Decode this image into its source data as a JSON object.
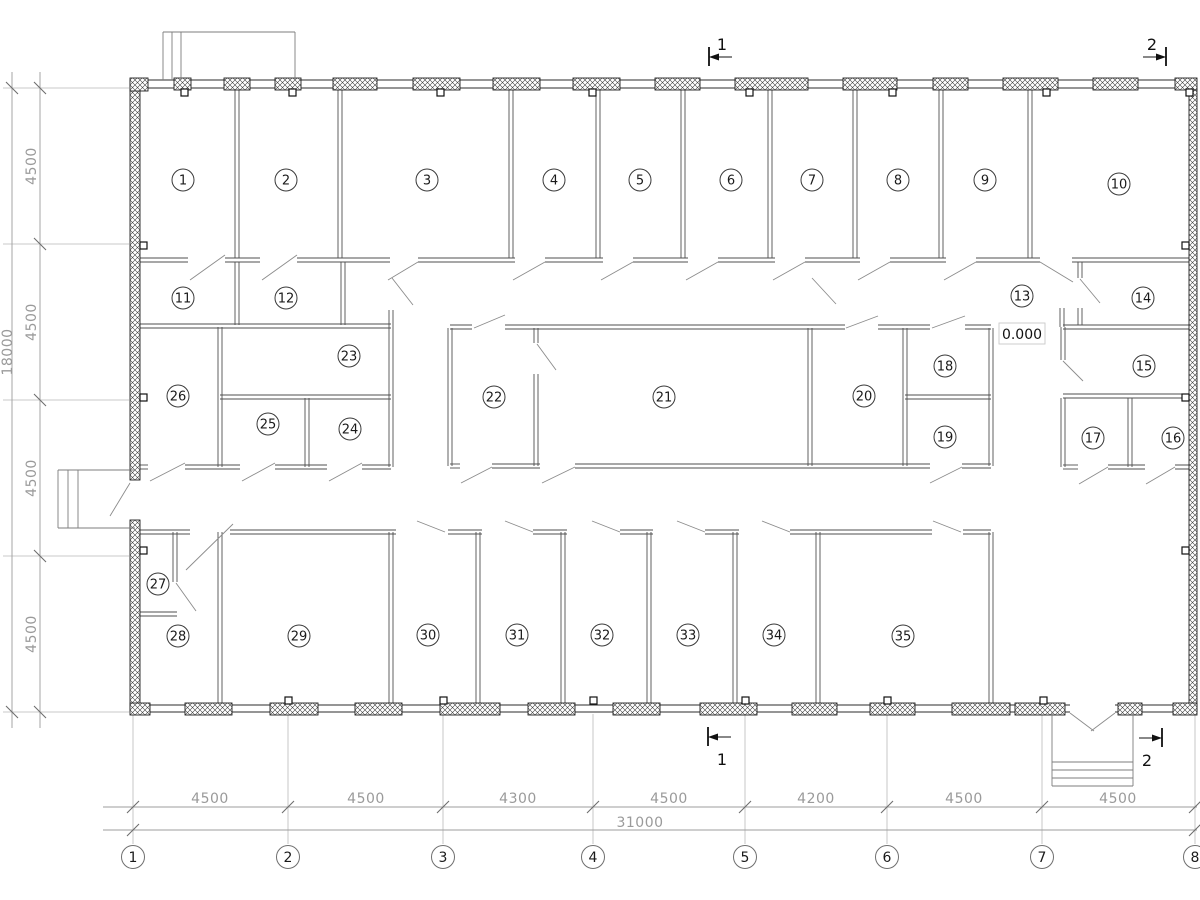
{
  "rooms": [
    {
      "n": "1",
      "x": 183,
      "y": 180
    },
    {
      "n": "2",
      "x": 286,
      "y": 180
    },
    {
      "n": "3",
      "x": 427,
      "y": 180
    },
    {
      "n": "4",
      "x": 554,
      "y": 180
    },
    {
      "n": "5",
      "x": 640,
      "y": 180
    },
    {
      "n": "6",
      "x": 731,
      "y": 180
    },
    {
      "n": "7",
      "x": 812,
      "y": 180
    },
    {
      "n": "8",
      "x": 898,
      "y": 180
    },
    {
      "n": "9",
      "x": 985,
      "y": 180
    },
    {
      "n": "10",
      "x": 1119,
      "y": 184
    },
    {
      "n": "11",
      "x": 183,
      "y": 298
    },
    {
      "n": "12",
      "x": 286,
      "y": 298
    },
    {
      "n": "13",
      "x": 1022,
      "y": 296
    },
    {
      "n": "14",
      "x": 1143,
      "y": 298
    },
    {
      "n": "15",
      "x": 1144,
      "y": 366
    },
    {
      "n": "16",
      "x": 1173,
      "y": 438
    },
    {
      "n": "17",
      "x": 1093,
      "y": 438
    },
    {
      "n": "18",
      "x": 945,
      "y": 366
    },
    {
      "n": "19",
      "x": 945,
      "y": 437
    },
    {
      "n": "20",
      "x": 864,
      "y": 396
    },
    {
      "n": "21",
      "x": 664,
      "y": 397
    },
    {
      "n": "22",
      "x": 494,
      "y": 397
    },
    {
      "n": "23",
      "x": 349,
      "y": 356
    },
    {
      "n": "24",
      "x": 350,
      "y": 429
    },
    {
      "n": "25",
      "x": 268,
      "y": 424
    },
    {
      "n": "26",
      "x": 178,
      "y": 396
    },
    {
      "n": "27",
      "x": 158,
      "y": 584
    },
    {
      "n": "28",
      "x": 178,
      "y": 636
    },
    {
      "n": "29",
      "x": 299,
      "y": 636
    },
    {
      "n": "30",
      "x": 428,
      "y": 635
    },
    {
      "n": "31",
      "x": 517,
      "y": 635
    },
    {
      "n": "32",
      "x": 602,
      "y": 635
    },
    {
      "n": "33",
      "x": 688,
      "y": 635
    },
    {
      "n": "34",
      "x": 774,
      "y": 635
    },
    {
      "n": "35",
      "x": 903,
      "y": 636
    }
  ],
  "grid_axis": {
    "y": 857,
    "items": [
      {
        "label": "1",
        "x": 133
      },
      {
        "label": "2",
        "x": 288
      },
      {
        "label": "3",
        "x": 443
      },
      {
        "label": "4",
        "x": 593
      },
      {
        "label": "5",
        "x": 745
      },
      {
        "label": "6",
        "x": 887
      },
      {
        "label": "7",
        "x": 1042
      },
      {
        "label": "8",
        "x": 1195
      }
    ]
  },
  "dims_bottom": {
    "chain": [
      {
        "label": "4500",
        "x": 210
      },
      {
        "label": "4500",
        "x": 366
      },
      {
        "label": "4300",
        "x": 518
      },
      {
        "label": "4500",
        "x": 669
      },
      {
        "label": "4200",
        "x": 816
      },
      {
        "label": "4500",
        "x": 964
      },
      {
        "label": "4500",
        "x": 1118
      }
    ],
    "overall": {
      "label": "31000",
      "x": 640,
      "y": 827
    }
  },
  "dims_left": {
    "chain": [
      {
        "label": "4500",
        "y": 166
      },
      {
        "label": "4500",
        "y": 322
      },
      {
        "label": "4500",
        "y": 478
      },
      {
        "label": "4500",
        "y": 634
      }
    ],
    "overall": {
      "label": "18000",
      "x": 12,
      "y": 352
    }
  },
  "sections": [
    {
      "label": "1",
      "instances": [
        {
          "x": 722,
          "y": 50
        },
        {
          "x": 722,
          "y": 765
        }
      ]
    },
    {
      "label": "2",
      "instances": [
        {
          "x": 1152,
          "y": 50
        },
        {
          "x": 1147,
          "y": 766
        }
      ]
    }
  ],
  "elevation": {
    "label": "0.000"
  }
}
